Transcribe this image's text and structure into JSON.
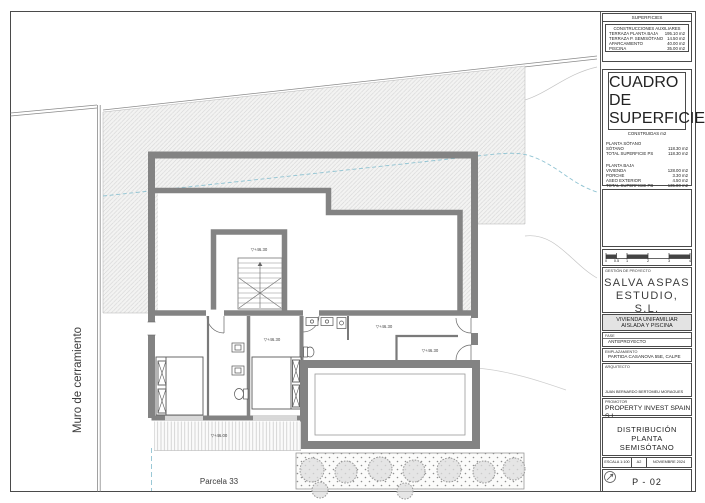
{
  "colors": {
    "wall_gray": "#838383",
    "hatch_line": "#d8d8d8",
    "contour_blue": "#8fc3d2",
    "shrub_gray": "#999999",
    "project_box_fill": "#e3e3e3"
  },
  "plan": {
    "muro_label": "Muro de cerramiento",
    "parcela_label": "Parcela 33",
    "levels": {
      "stair": "▽+46.30",
      "hall": "▽+46.30",
      "bedroom": "▽+46.30",
      "room": "▽+46.30",
      "terrace": "▽+46.00"
    }
  },
  "titleblock": {
    "superficies": {
      "title": "SUPERFICIES",
      "subtitle": "CONSTRUCCIONES AUXILIARES",
      "rows": [
        {
          "label": "TERRAZA PLANTA BAJA",
          "value": "195.10 m2"
        },
        {
          "label": "TERRAZA P. SEMISÓTANO",
          "value": "14.50 m2"
        },
        {
          "label": "APARCAMIENTO",
          "value": "40.00 m2"
        },
        {
          "label": "PISCINA",
          "value": "35.00 m2"
        }
      ]
    },
    "cuadro": {
      "title": "CUADRO DE SUPERFICIES",
      "subtitle": "CONSTRUIDAS m2",
      "s1_heading": "PLANTA SÓTANO",
      "s1_rows": [
        {
          "label": "SÓTANO",
          "value": "118.30 m2"
        },
        {
          "label": "TOTAL SUPERFICIE PS",
          "value": "118.30 m2"
        }
      ],
      "s2_heading": "PLANTA BAJA",
      "s2_rows": [
        {
          "label": "VIVIENDA",
          "value": "128.00 m2"
        },
        {
          "label": "PORCHE",
          "value": "3.30 m2"
        },
        {
          "label": "ASEO EXTERIOR",
          "value": "4.50 m2"
        },
        {
          "label": "TOTAL SUPERFICIE PB",
          "value": "135.80 m2"
        }
      ],
      "total_label": "TOTAL SUPERFICIE CONSTR.",
      "total_value": "254.10 m2"
    },
    "scalebar": [
      "0",
      "0.5",
      "1",
      "2",
      "3",
      "4"
    ],
    "studio": {
      "label": "GESTIÓN DE PROYECTO",
      "name_line1": "SALVA ASPAS",
      "name_line2": "ESTUDIO, S.L."
    },
    "project": {
      "line1": "VIVIENDA UNIFAMILIAR",
      "line2": "AISLADA Y PISCINA"
    },
    "fase": {
      "label": "FASE",
      "value": "ANTEPROYECTO"
    },
    "emplazamiento": {
      "label": "EMPLAZAMIENTO",
      "value": "PARTIDA CASANOVA 55E, CALPE"
    },
    "arquitecto": {
      "label": "ARQUITECTO",
      "value": "JUAN BERNARDO BERTOMEU MORAGUES"
    },
    "promotor": {
      "label": "PROMOTOR",
      "value": "PROPERTY INVEST SPAIN S.L."
    },
    "drawing": {
      "line1": "DISTRIBUCIÓN",
      "line2": "PLANTA SEMISÓTANO"
    },
    "meta": {
      "escala": "ESCALA 1:100",
      "formato": "A2",
      "fecha": "NOVIEMBRE 2024"
    },
    "sheet_number": "P - 02"
  }
}
